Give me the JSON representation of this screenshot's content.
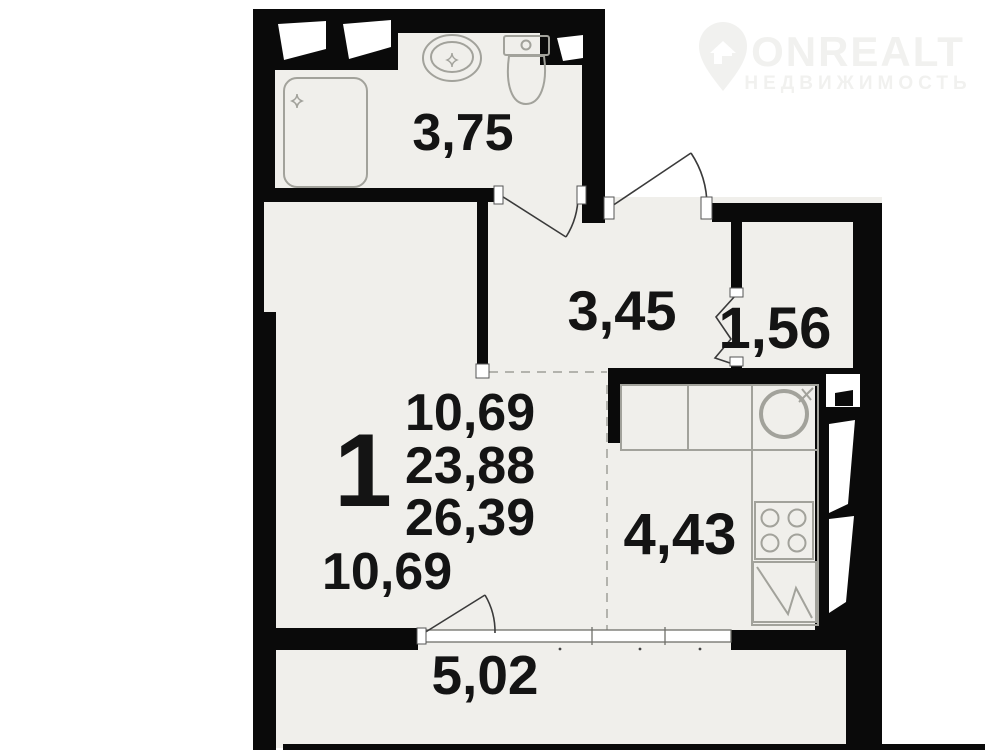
{
  "watermark": {
    "brand": "ONREALT",
    "tagline": "НЕДВИЖИМОСТЬ"
  },
  "plan": {
    "rooms_count": "1",
    "areas_summary": {
      "living": "10,69",
      "total": "23,88",
      "total_with_loggia": "26,39"
    },
    "rooms": {
      "bathroom": "3,75",
      "hallway": "3,45",
      "wardrobe": "1,56",
      "living_room": "10,69",
      "kitchen": "4,43",
      "loggia": "5,02"
    }
  },
  "colors": {
    "wall": "#0a0a0a",
    "floor": "#f0efeb",
    "fixture": "#a2a29b",
    "text": "#141414",
    "watermark": "#f1f1ef",
    "door": "#3a3a3a",
    "dash": "#b3b3ad"
  }
}
